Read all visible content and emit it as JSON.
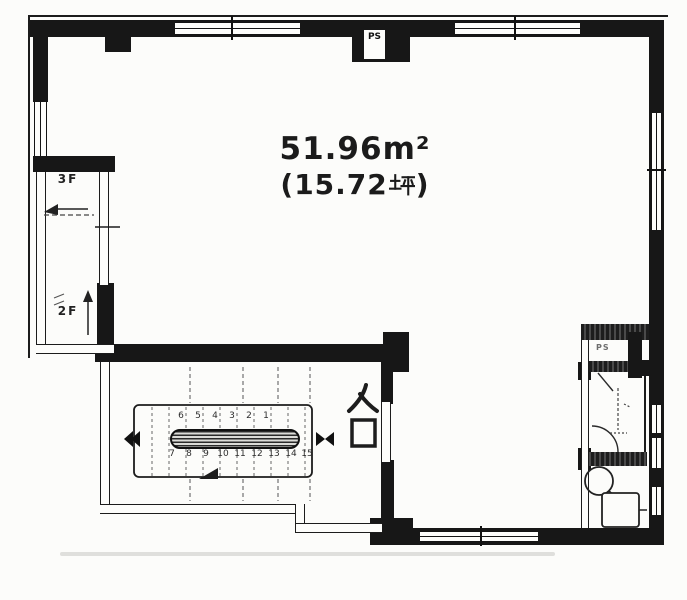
{
  "document_type": "floor-plan",
  "colors": {
    "wall": "#171717",
    "hatch_wall": "#4a4a4a",
    "background": "#fcfcfa",
    "text": "#1b1b1b"
  },
  "area": {
    "sqm": "51.96㎡",
    "sqm_num": "51.96",
    "sqm_unit": "m²",
    "tsubo": "(15.72坪)",
    "tsubo_prefix": "(15.72",
    "tsubo_suffix": ")"
  },
  "entrance": {
    "label": "入口"
  },
  "stairwell": {
    "upper_floor": "3F",
    "lower_floor": "2F"
  },
  "pipe_space": {
    "label": "PS"
  },
  "toilet": {
    "ps_label": "PS"
  },
  "stairs": {
    "top_row": [
      "6",
      "5",
      "4",
      "3",
      "2",
      "1"
    ],
    "bottom_row": [
      "7",
      "8",
      "9",
      "10",
      "11",
      "12",
      "13",
      "14",
      "15"
    ]
  }
}
